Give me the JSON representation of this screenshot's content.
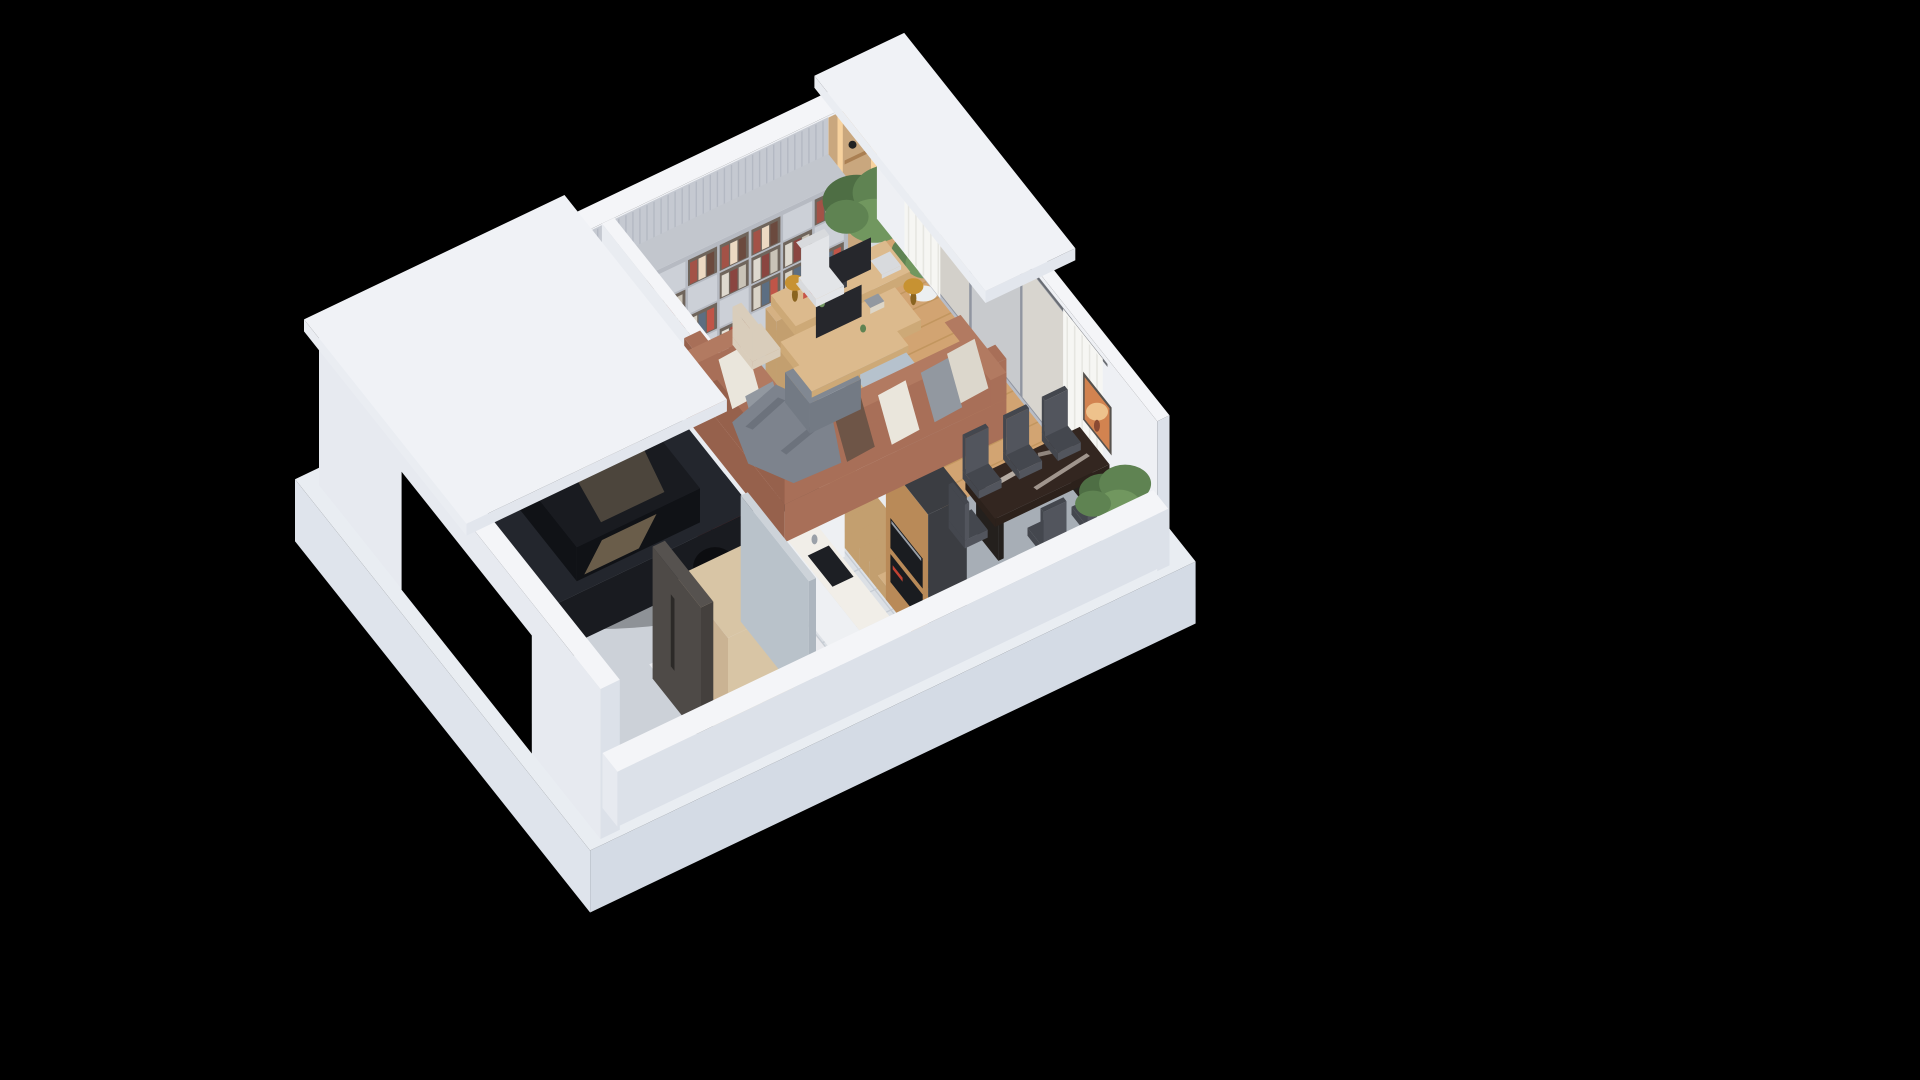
{
  "meta": {
    "title": "Isometric 3D Floor Plan — Ground Floor Cutaway",
    "view": "isometric dollhouse cutaway render",
    "background": "#000000"
  },
  "palette": {
    "bg": "#000000",
    "plinthTop": "#e9edf2",
    "plinthFace": "#dfe4ec",
    "plinthDark": "#d4dbe5",
    "concrete": "#ccd1d8",
    "tile": "#dce0e5",
    "grout": "#c6ccd4",
    "marbleFloor": "#e9eaee",
    "wood": "#d2a472",
    "woodLine": "#c2965f",
    "rugLiving": "#b6c2cd",
    "rugDining": "#a7aeb6",
    "wallWhite": "#f4f5f8",
    "wallInner": "#eef0f4",
    "wallExt": "#e7eaf0",
    "wallExtShade": "#dce1e9",
    "roofTop": "#f0f2f6",
    "roofEdge": "#e2e6ed",
    "roofEdgeLight": "#eaedf2",
    "marblePanel": "#ece5df",
    "marbleVein": "#d8cfc8",
    "slatPanel": "#c5c9d1",
    "slatLine": "#b4b9c3",
    "nookWood": "#c9a77e",
    "nookGlow": "#ffd9a3",
    "nookShelf": "#aa7f52",
    "shelfCarcass": "#b6bac2",
    "shelfSide": "#aeb3bb",
    "shelfTop": "#c2c6cd",
    "shelfClosed": "#ccd0d7",
    "shelfOpenBg": "#6f655c",
    "books": [
      "#e6e2d8",
      "#b0493f",
      "#7e3b34",
      "#d9d3c7",
      "#5c6e82",
      "#c05548",
      "#ded9cf",
      "#8a4540",
      "#c9c3b7",
      "#a35247",
      "#ecd9c2",
      "#6b4a3e"
    ],
    "plantGreen1": "#4e6e44",
    "plantGreen2": "#5f8352",
    "plantGreen3": "#71975f",
    "potWhite": "#eceff1",
    "potShade": "#dfe3e6",
    "potTop": "#d5dadd",
    "windowFrame": "#9095a0",
    "glass1": "#d3d0ca",
    "glass2": "#c8cacd",
    "glass3": "#d8d5cf",
    "sill": "#b9bdc6",
    "curtain": "#f6f6f3",
    "curtainFold": "#e6e6e1",
    "rod": "#6a6d73",
    "artFrame": "#56524e",
    "artBg": "#d28350",
    "artSun": "#eec28c",
    "artDetail": "#8a4a33",
    "dividerWest": "#e9ecf1",
    "dividerSouth": "#e2e6ec",
    "toolRed": "#c23b32",
    "toolRedDark": "#a32e27",
    "toolBlack": "#23252a",
    "carBody": "#191b20",
    "carBodyLight": "#23262d",
    "carGlass": "#101216",
    "carReflect": "#c4a87e",
    "carShadow": "rgba(0,0,0,0.30)",
    "wheelDark": "#0c0d10",
    "stairsWood": "#d5b183",
    "stairsRiser": "#c39f6f",
    "stairSide": "#e9ecf0",
    "counterWhite": "#eef0f3",
    "counterSide": "#e2e5ea",
    "counterTop": "#f1eee8",
    "sinkDark": "#1d1f24",
    "cooktop": "#2a2c31",
    "towerWood": "#b98a58",
    "towerDark": "#3b3d42",
    "ovenBlack": "#1a1c20",
    "ovenSteel": "#9aa0a8",
    "ovenDetail": "#c24232",
    "sofa": "#a86f58",
    "sofaDark": "#96614c",
    "sofaSeat": "#b27a61",
    "pillowWhite": "#eae6dc",
    "pillowGray": "#9298a0",
    "pillowDark": "#6e5547",
    "pillowZig": "#dcd7cc",
    "blanket": "#7d838d",
    "blanketFold": "#6c727c",
    "ottoman": "#737a84",
    "ottomanTop": "#818892",
    "deskWood": "#dcba8d",
    "deskSide": "#cda977",
    "monitor": "#26272c",
    "monitorStand": "#3c3e44",
    "laptop": "#d8dadd",
    "lampGold": "#c79232",
    "lampDark": "#8a6420",
    "chairWhite": "#e3e5e8",
    "chairWhiteShade": "#d8dadd",
    "chairBeige": "#d9cdbb",
    "tableTop": "#332620",
    "tableSide": "#2c211b",
    "tableVein": "#cfc5bc",
    "tableLeg": "#24201d",
    "chairDark": "#44474e",
    "chairDarkLight": "#52555d",
    "doorDark": "#4e4a47",
    "doorSide": "#44403d",
    "doorTop": "#56524f",
    "doorHandle": "#2c2a28",
    "wardrobe": "#d8c5a5",
    "wardrobeSide": "#cab393",
    "glassPartition": "#b9c2ca",
    "glassPartSouth": "#adb6bf",
    "glassPartTop": "#cdd3d9",
    "bookRed": "#c75548",
    "bookCream": "#ddd6c8"
  },
  "rooms": [
    {
      "name": "Garage",
      "items": [
        "black sports car",
        "red tool cabinet",
        "red toolbox trolley",
        "gray sectional garage door",
        "concrete floor"
      ]
    },
    {
      "name": "Entry Hall",
      "items": [
        "dark front door with long vertical handle",
        "light wood wardrobe cabinet",
        "glass partition wall",
        "marble floor"
      ]
    },
    {
      "name": "Kitchen",
      "items": [
        "white marble L-shaped counter",
        "dark undermount sink",
        "built-in cooktop",
        "tall oak oven tower with two built-in black ovens",
        "porcelain tile floor"
      ]
    },
    {
      "name": "Staircase",
      "items": [
        "oak winder staircase",
        "white stringer wall"
      ]
    },
    {
      "name": "Living Room",
      "items": [
        "gray bookshelf wall with books and binders",
        "marble accent wall panel",
        "slatted gray wall panel",
        "wood entrance nook with warm LED strips",
        "two potted green plants",
        "double oak desk with two monitors",
        "two brass mushroom desk lamps",
        "white desk chair",
        "beige desk chair",
        "brown leather corner sofa",
        "patterned throw pillows",
        "gray throw blanket",
        "gray ottoman",
        "blue-gray area rug",
        "oak plank flooring"
      ]
    },
    {
      "name": "Dining Area",
      "items": [
        "dark marble dining table",
        "five dark upholstered dining chairs",
        "gray area rug",
        "orange abstract wall art",
        "potted plant",
        "white curtains on rail",
        "sliding glass window wall"
      ]
    }
  ]
}
